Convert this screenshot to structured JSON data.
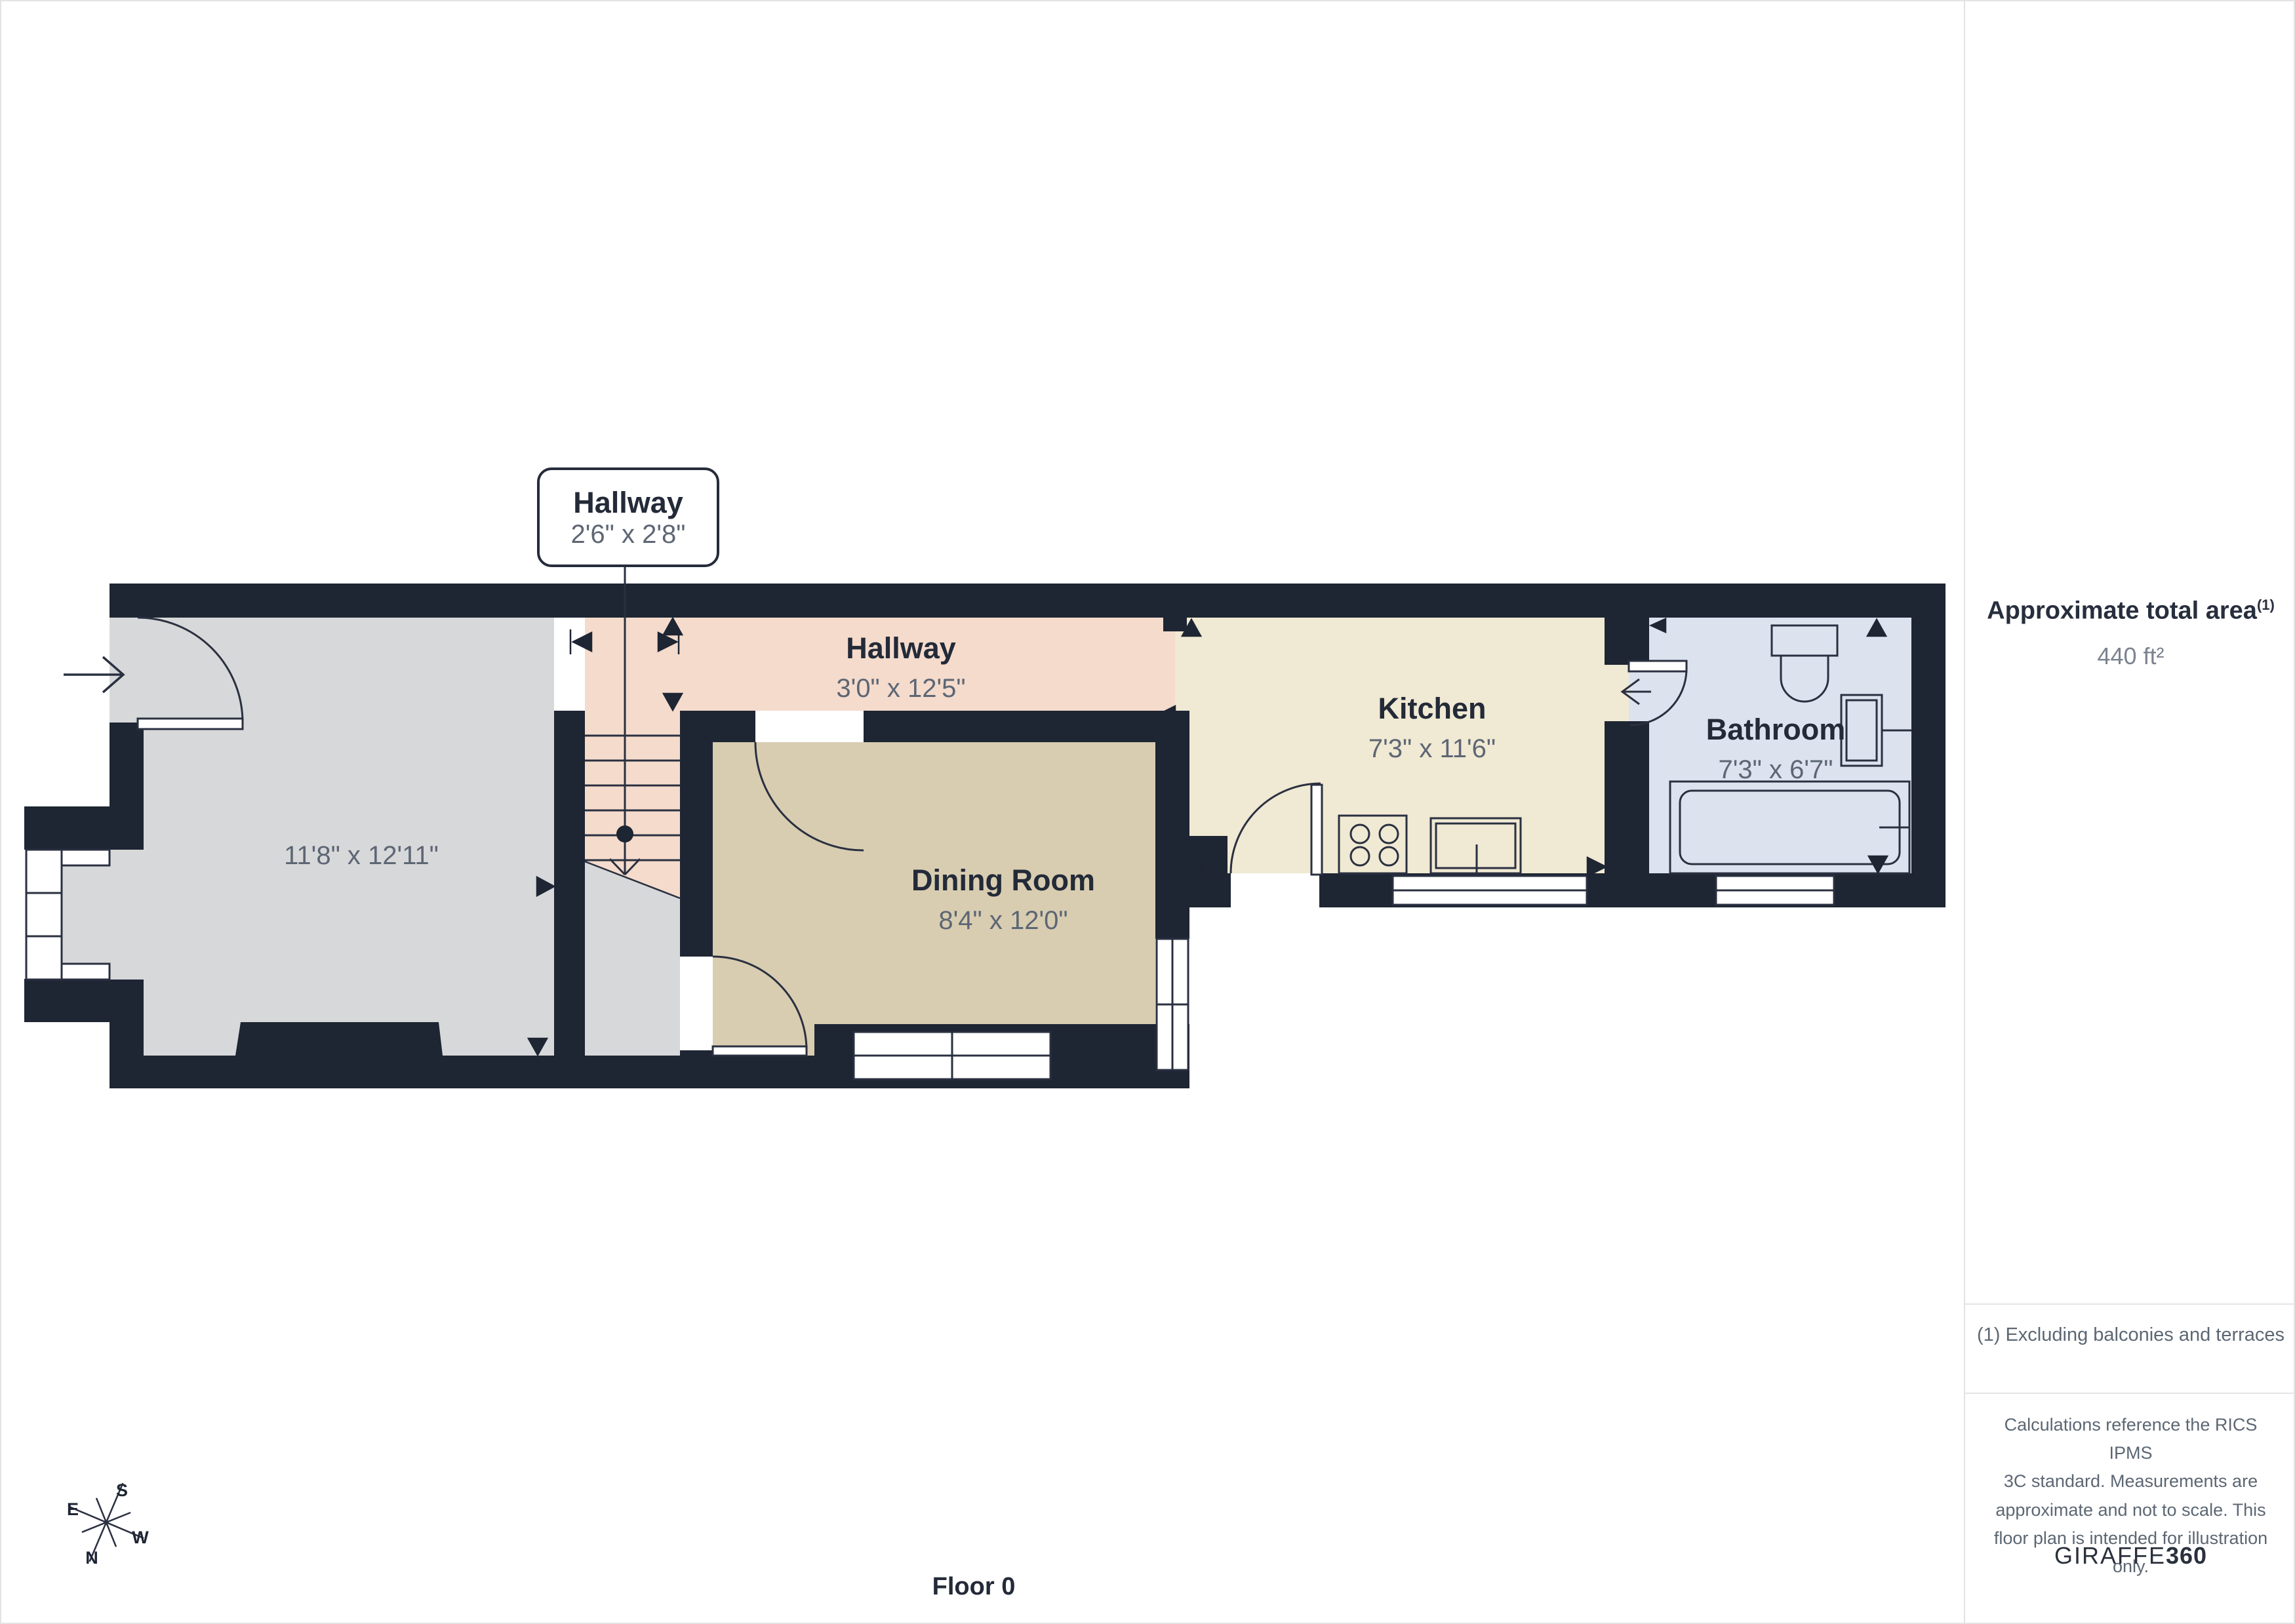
{
  "colors": {
    "wall": "#1e2533",
    "outline": "#2a3040",
    "room_living": "#d7d8d9",
    "room_hallway": "#f4dbcc",
    "room_dining": "#d8cdb1",
    "room_kitchen": "#f0e9d3",
    "room_bathroom": "#dce3ee",
    "window": "#ffffff",
    "text_dark": "#232a38",
    "text_gray": "#5d6674",
    "divider": "#e3e3e3"
  },
  "plan": {
    "callout": {
      "title": "Hallway",
      "dims": "2'6\" x 2'8\""
    },
    "rooms": {
      "hallway": {
        "name": "Hallway",
        "dims": "3'0\" x 12'5\""
      },
      "kitchen": {
        "name": "Kitchen",
        "dims": "7'3\" x 11'6\""
      },
      "bathroom": {
        "name": "Bathroom",
        "dims": "7'3\" x 6'7\""
      },
      "dining": {
        "name": "Dining Room",
        "dims": "8'4\" x 12'0\""
      },
      "living": {
        "dims": "11'8\" x 12'11\""
      }
    },
    "floor_label": "Floor 0",
    "compass": {
      "n": "N",
      "s": "S",
      "e": "E",
      "w": "W"
    }
  },
  "sidebar": {
    "area_title": "Approximate total area",
    "area_footnote_marker": "(1)",
    "area_value": "440 ft²",
    "footnote": "(1) Excluding balconies and terraces",
    "disclaimer": "Calculations reference the RICS IPMS\n3C standard. Measurements are\napproximate and not to scale. This\nfloor plan is intended for illustration\nonly.",
    "brand_name": "GIRAFFE",
    "brand_suffix": "360"
  }
}
